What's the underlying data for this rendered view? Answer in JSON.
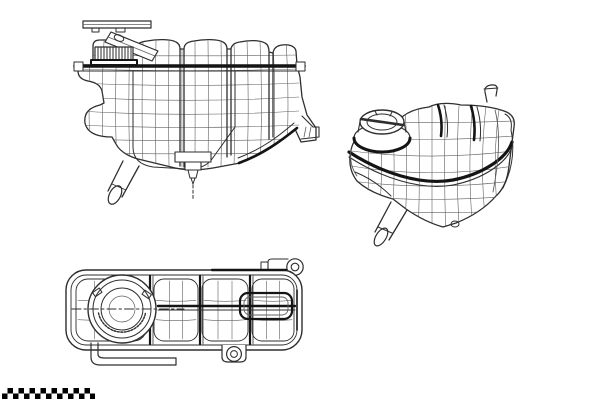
{
  "page": {
    "background_color": "#ffffff"
  },
  "drawing": {
    "ink_color": "#2e2e2e",
    "heavy_line_color": "#141414",
    "mesh_line_color": "#5f5f5f",
    "fill_color": "#ffffff",
    "subject": "coolant-expansion-tank-wireframe",
    "views": [
      {
        "name": "tank-side-view"
      },
      {
        "name": "tank-perspective-view"
      },
      {
        "name": "tank-top-view"
      }
    ]
  },
  "watermark": {
    "dark_color": "#000000",
    "light_color": "#ffffff",
    "rows": 2,
    "columns": 17
  }
}
